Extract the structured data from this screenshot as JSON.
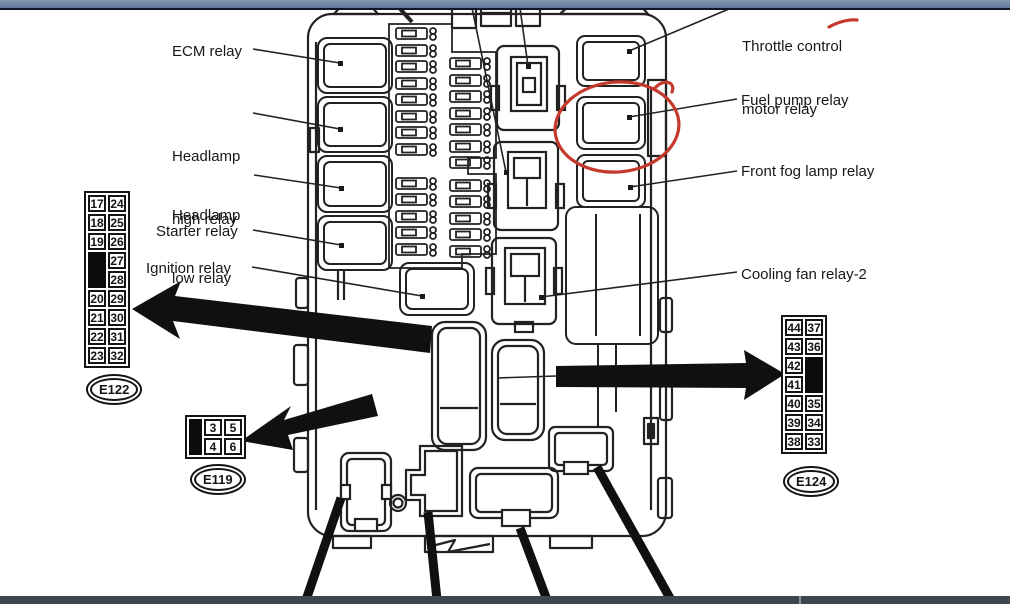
{
  "labels": {
    "ecm": "ECM relay",
    "headlamp_high_1": "Headlamp",
    "headlamp_high_2": "high relay",
    "headlamp_low_1": "Headlamp",
    "headlamp_low_2": "low relay",
    "starter": "Starter relay",
    "ignition": "Ignition relay",
    "throttle_1": "Throttle control",
    "throttle_2": "motor relay",
    "fuel_pump": "Fuel pump relay",
    "front_fog": "Front fog lamp relay",
    "cooling_fan": "Cooling fan relay-2"
  },
  "connectors": {
    "e122": {
      "label": "E122",
      "col1": [
        "17",
        "18",
        "19",
        "20",
        "21",
        "22",
        "23"
      ],
      "col2": [
        "24",
        "25",
        "26",
        "27",
        "28",
        "29",
        "30",
        "31",
        "32"
      ]
    },
    "e119": {
      "label": "E119",
      "row1": [
        "3",
        "5"
      ],
      "row2": [
        "4",
        "6"
      ]
    },
    "e124": {
      "label": "E124",
      "col1": [
        "44",
        "43",
        "42",
        "41",
        "40",
        "39",
        "38"
      ],
      "col2": [
        "37",
        "36",
        "35",
        "34",
        "33"
      ]
    }
  },
  "colors": {
    "annotation_red": "#c5382c",
    "line_art": "#222222",
    "top_bar": "#6e84a3",
    "bottom_bar": "#3e4450"
  }
}
